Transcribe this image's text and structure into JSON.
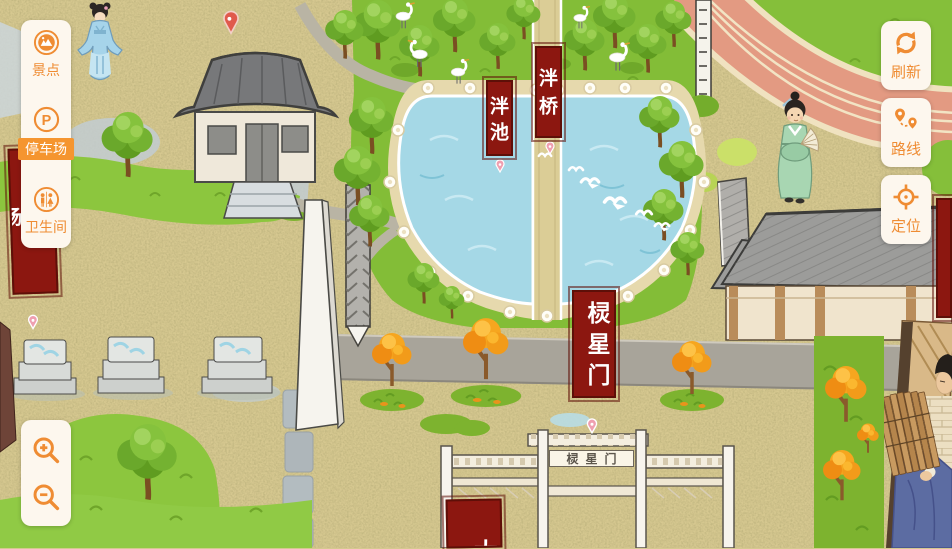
{
  "ui": {
    "accent_color": "#ef8c33",
    "card_color": "#fdf7ee",
    "sidebar": {
      "items": [
        {
          "label": "景点",
          "icon": "scenic-spot-icon",
          "active": false
        },
        {
          "label": "停车场",
          "icon": "parking-icon",
          "active": true
        },
        {
          "label": "卫生间",
          "icon": "restroom-icon",
          "active": false
        }
      ],
      "parking_icon_letter": "P"
    },
    "toolbar": {
      "items": [
        {
          "label": "刷新",
          "icon": "refresh-icon"
        },
        {
          "label": "路线",
          "icon": "route-icon"
        },
        {
          "label": "定位",
          "icon": "locate-icon"
        }
      ]
    }
  },
  "map": {
    "banner_color": "#8c1710",
    "labels": {
      "pan_bridge": "泮桥",
      "pan_pond": "泮池",
      "lingxing_gate_banner": "棂星门",
      "lingxing_gate_plaque": "棂星门",
      "parking_lot_banner": "停车场",
      "south_banner_partial": "太"
    }
  }
}
